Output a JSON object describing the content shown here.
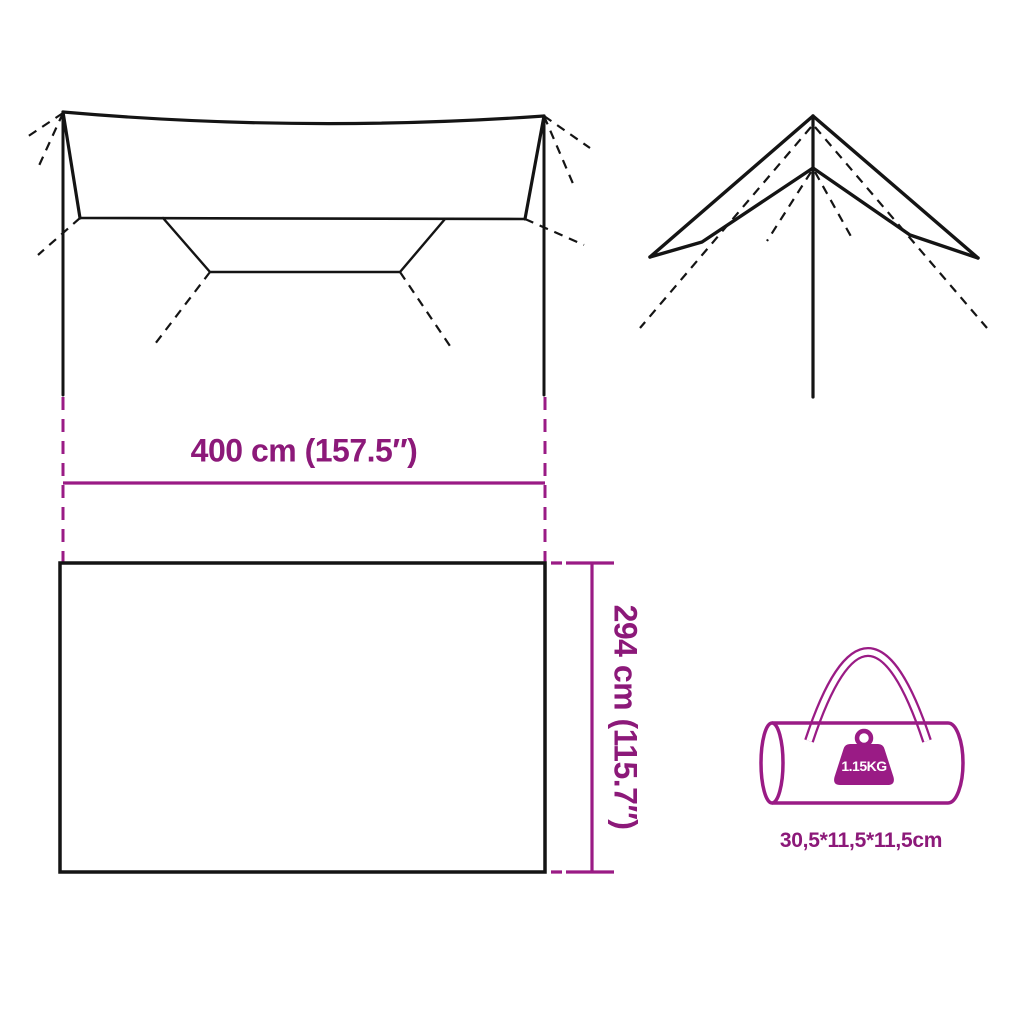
{
  "labels": {
    "tarp_width": "400 cm (157.5″)",
    "tarp_height": "294 cm (115.7″)",
    "weight": "1.15KG",
    "packed_size": "30,5*11,5*11,5cm"
  },
  "colors": {
    "accent": "#9A1B85",
    "text": "#8C1979",
    "line": "#141414",
    "background": "#FFFFFF"
  }
}
